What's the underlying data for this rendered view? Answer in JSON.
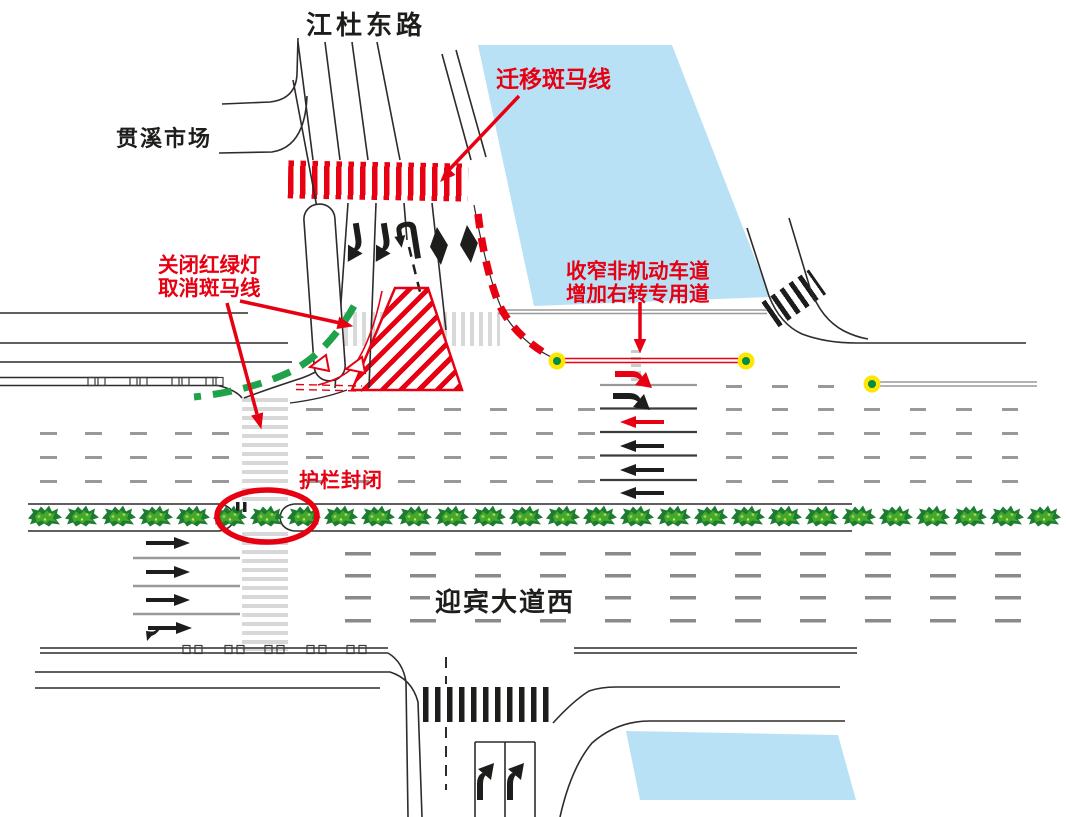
{
  "road_labels": {
    "top_road": "江杜东路",
    "market": "贯溪市场",
    "main_road": "迎宾大道西"
  },
  "annotations": {
    "move_crosswalk": "迁移斑马线",
    "close_signal_line1": "关闭红绿灯",
    "close_signal_line2": "取消斑马线",
    "narrow_lane_line1": "收窄非机动车道",
    "narrow_lane_line2": "增加右转专用道",
    "guardrail_closed": "护栏封闭"
  },
  "colors": {
    "annotation_red": "#e60012",
    "guide_green": "#1fa24a",
    "building_blue": "#b9e1f6",
    "closed_crossing_gray": "#d8d8d8",
    "marker_dot_yellow": "#ffe600",
    "marker_dot_green": "#008c45"
  }
}
